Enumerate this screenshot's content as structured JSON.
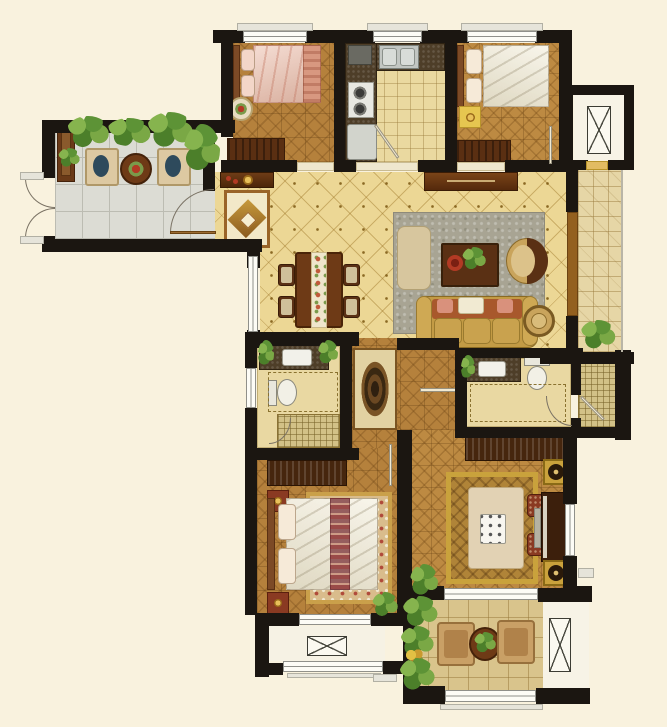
{
  "meta": {
    "description": "Color-rendered top-down residential apartment floor plan with furniture",
    "canvas": {
      "width": 667,
      "height": 727
    },
    "visible_text": "none"
  },
  "palette": {
    "background": "#f9f2de",
    "wall": "#1b1611",
    "wood_floor": "#b5813c",
    "gold_tile": "#ecd795",
    "gray_tile": "#dcdcd4",
    "tan_tile": "#d9c48c",
    "entry_tile": "#e6d6a6",
    "granite_counter": "#4e3e28",
    "dark_wood_furniture": "#5a2f12",
    "sofa_gold": "#c39b45",
    "bed_pink": "#ecc0ae",
    "linen_white": "#f1ebd6",
    "living_rug_green": "#a8a493",
    "plant_green": "#5d9336",
    "accent_red": "#b23a24",
    "window_white": "#fdfcf6"
  },
  "rooms": [
    {
      "label": "left balcony",
      "furniture": [
        "storage cabinet",
        "lounge chair",
        "round tea table with flowers",
        "lounge chair",
        "potted plants",
        "outward-swinging french doors",
        "door to foyer"
      ]
    },
    {
      "label": "secondary bedroom (pink bedding)",
      "furniture": [
        "double bed",
        "round bedside table",
        "dresser"
      ]
    },
    {
      "label": "kitchen",
      "furniture": [
        "double sink",
        "two-burner cooktop",
        "refrigerator",
        "L-shaped granite counter"
      ]
    },
    {
      "label": "secondary bedroom (white bedding)",
      "furniture": [
        "double bed",
        "yellow nightstand lamp table",
        "dresser"
      ]
    },
    {
      "label": "elevator lobby and entry hall",
      "furniture": [
        "elevator shaft with X symbol",
        "entry mat",
        "tiled hall",
        "potted plant"
      ]
    },
    {
      "label": "living and dining room",
      "furniture": [
        "entry console table",
        "medallion entry rug",
        "dining table with runner and four chairs",
        "tv cabinet",
        "gray-green area rug",
        "ottoman bench",
        "coffee table with plant and red dish",
        "crescent armchair",
        "three-seat gold sofa",
        "round side table"
      ]
    },
    {
      "label": "master bathroom",
      "furniture": [
        "granite vanity with sink",
        "toilet",
        "mosaic shower area",
        "west window"
      ]
    },
    {
      "label": "hallway",
      "furniture": [
        "dark medallion runner rug",
        "parquet corridor"
      ]
    },
    {
      "label": "shared bathroom",
      "furniture": [
        "granite vanity with sink",
        "toilet",
        "mosaic shower room"
      ]
    },
    {
      "label": "master bedroom",
      "furniture": [
        "wardrobe",
        "double bed with decorative runner",
        "two nightstands",
        "floral area rug",
        "potted plant",
        "bay window with x-mullion"
      ]
    },
    {
      "label": "study",
      "furniture": [
        "wardrobe",
        "desk with white device",
        "two upholstered stools",
        "upright piano with bench",
        "two speakers",
        "gold area rug",
        "east window"
      ]
    },
    {
      "label": "bottom balcony",
      "furniture": [
        "two wicker chairs",
        "round table with plant",
        "potted plants",
        "duct shaft with X symbol",
        "south window"
      ]
    }
  ]
}
